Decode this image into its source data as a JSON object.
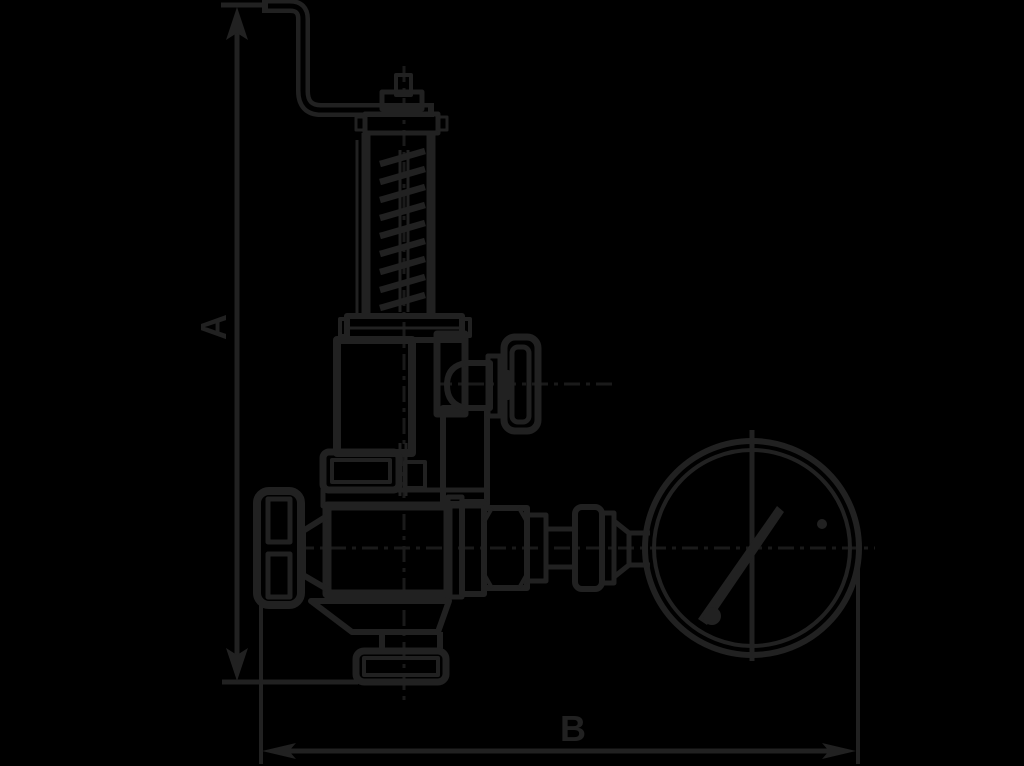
{
  "drawing": {
    "kind": "technical outline drawing",
    "subject": "angle safety relief valve with test lever, spring bonnet, inlet handwheel, gauge isolation valve and round pressure gauge",
    "colors": {
      "background": "#000000",
      "line": "#212121",
      "centerline": "#1a1a1a"
    },
    "dimensions": {
      "a_label": "A",
      "a_orientation": "vertical",
      "b_label": "B",
      "b_orientation": "horizontal"
    },
    "parts": [
      "test-lever",
      "adjusting-cap",
      "spring-bonnet",
      "coil-spring",
      "bonnet-flange",
      "spring-chamber",
      "gauge-isolation-valve",
      "isolation-handwheel",
      "inlet-handwheel",
      "valve-body",
      "outlet-flange",
      "pipe-fittings",
      "pressure-gauge",
      "gauge-needle"
    ]
  }
}
